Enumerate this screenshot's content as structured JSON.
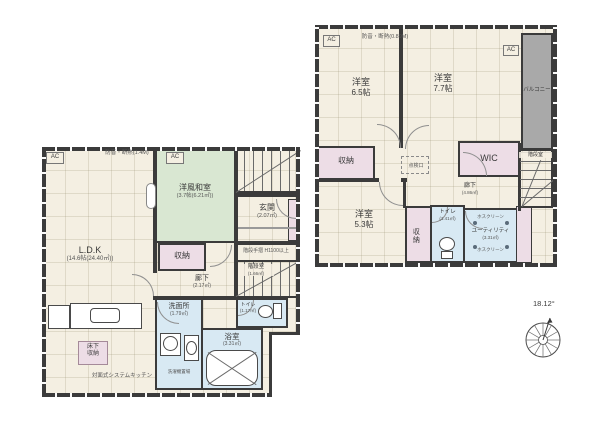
{
  "palette": {
    "wall": "#3b3b3b",
    "floor": "#f4efe2",
    "tatami_room": "#d9e7d2",
    "storage": "#eddde6",
    "wet_area": "#d8e9f3",
    "balcony": "#a9a9a9"
  },
  "floor1": {
    "ac_left": "AC",
    "ac_right": "AC",
    "top_note": "防音・断熱(1.4M)",
    "ldk": {
      "name": "L.D.K",
      "size": "(14.6帖(24.40㎡))"
    },
    "washitsu": {
      "name": "洋風和室",
      "size": "(3.7帖(6.21㎡))"
    },
    "closet": "収納",
    "genkan": {
      "name": "玄関",
      "size": "(2.07㎡)"
    },
    "hallway": {
      "name": "廊下",
      "size": "(2.17㎡)"
    },
    "stair": {
      "name": "階段室",
      "size": "(1.66㎡)"
    },
    "handrail_note": "階段手摺 H1100以上",
    "toilet": {
      "name": "トイレ",
      "size": "(1.17㎡)"
    },
    "washroom": {
      "name": "洗面所",
      "size": "(1.79㎡)"
    },
    "laundry_note": "洗濯機置場",
    "bath": {
      "name": "浴室",
      "size": "(3.31㎡)"
    },
    "underfloor": {
      "line1": "床下",
      "line2": "収納"
    },
    "kitchen_note": "対面式システムキッチン"
  },
  "floor2": {
    "ac_left": "AC",
    "ac_right": "AC",
    "top_note": "防音・断熱(0.89M)",
    "room_a": {
      "name": "洋室",
      "size": "6.5帖"
    },
    "room_b": {
      "name": "洋室",
      "size": "7.7帖"
    },
    "room_c": {
      "name": "洋室",
      "size": "5.3帖"
    },
    "balcony": "バルコニー",
    "wic": "WIC",
    "closet_a": "収納",
    "closet_b": "収納",
    "hallway": {
      "name": "廊下",
      "size": "(4.86㎡)"
    },
    "toilet": {
      "name": "トイレ",
      "size": "(1.41㎡)"
    },
    "utility": {
      "name": "ユーティリティ",
      "size": "(3.31㎡)"
    },
    "hoscreen_top": "ホスクリーン",
    "hoscreen_bottom": "ホスクリーン",
    "stair": "階段室",
    "hatch": "点検口"
  },
  "compass": {
    "angle": "18.12°"
  }
}
